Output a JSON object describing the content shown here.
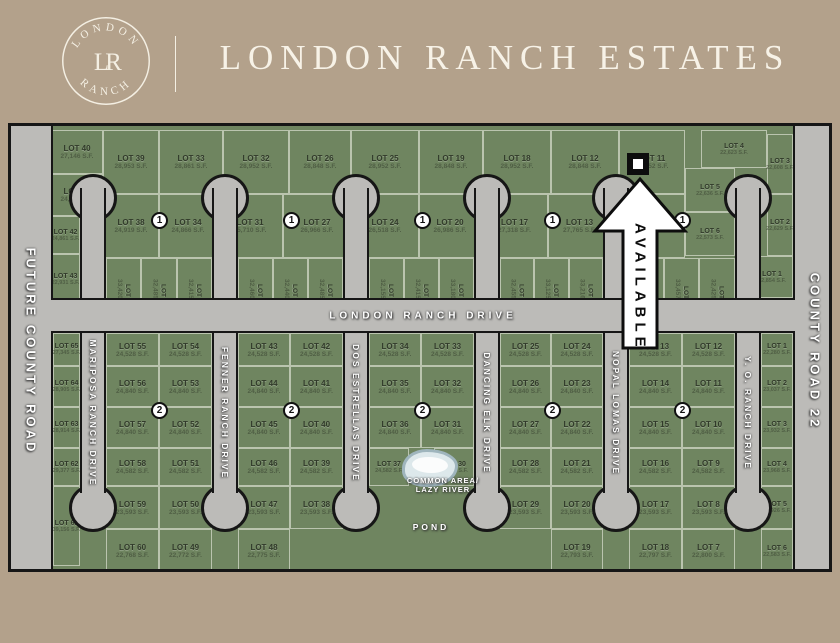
{
  "header": {
    "logo_top": "LONDON",
    "logo_bottom": "RANCH",
    "logo_monogram": "LR",
    "title": "LONDON RANCH ESTATES"
  },
  "roads": {
    "left": "FUTURE COUNTY ROAD",
    "right": "COUNTY ROAD 22",
    "main": "LONDON RANCH DRIVE",
    "south_streets": [
      "MARIPOSA RANCH DRIVE",
      "FENNER RANCH DRIVE",
      "DOS ESTRELLAS DRIVE",
      "DANCING ELK DRIVE",
      "NOPAL LOMAS DRIVE",
      "Y. O. RANCH DRIVE"
    ]
  },
  "badges": {
    "unit1": "1",
    "unit2": "2"
  },
  "available_marker": {
    "label": "AVAILABLE"
  },
  "common_area": {
    "line1": "COMMON AREA/",
    "line2": "LAZY RIVER",
    "pond": "POND"
  },
  "colors": {
    "background_tan": "#b3a18b",
    "map_green": "#6f8560",
    "road_gray": "#bcbbb8",
    "outline_black": "#161616",
    "cream": "#f7f2e7"
  },
  "north_lots": [
    {
      "id": "N40",
      "label": "LOT 40",
      "sf": "27,146 S.F."
    },
    {
      "id": "N39",
      "label": "LOT 39",
      "sf": "28,953 S.F."
    },
    {
      "id": "N33",
      "label": "LOT 33",
      "sf": "28,861 S.F."
    },
    {
      "id": "N32",
      "label": "LOT 32",
      "sf": "28,952 S.F."
    },
    {
      "id": "N26",
      "label": "LOT 26",
      "sf": "28,848 S.F."
    },
    {
      "id": "N25",
      "label": "LOT 25",
      "sf": "28,952 S.F."
    },
    {
      "id": "N19",
      "label": "LOT 19",
      "sf": "28,848 S.F."
    },
    {
      "id": "N18",
      "label": "LOT 18",
      "sf": "28,952 S.F."
    },
    {
      "id": "N12",
      "label": "LOT 12",
      "sf": "28,848 S.F."
    },
    {
      "id": "N11",
      "label": "LOT 11",
      "sf": "28,952 S.F."
    },
    {
      "id": "N4",
      "label": "LOT 4",
      "sf": "22,623 S.F."
    },
    {
      "id": "N3",
      "label": "LOT 3",
      "sf": "22,608 S.F."
    },
    {
      "id": "N41",
      "label": "LOT 41",
      "sf": "24,885 S.F."
    },
    {
      "id": "N38",
      "label": "LOT 38",
      "sf": "24,919 S.F."
    },
    {
      "id": "N34",
      "label": "LOT 34",
      "sf": "24,866 S.F."
    },
    {
      "id": "N31",
      "label": "LOT 31",
      "sf": "25,710 S.F."
    },
    {
      "id": "N27",
      "label": "LOT 27",
      "sf": "26,966 S.F."
    },
    {
      "id": "N24",
      "label": "LOT 24",
      "sf": "26,518 S.F."
    },
    {
      "id": "N20",
      "label": "LOT 20",
      "sf": "26,986 S.F."
    },
    {
      "id": "N17",
      "label": "LOT 17",
      "sf": "27,318 S.F."
    },
    {
      "id": "N13",
      "label": "LOT 13",
      "sf": "27,765 S.F."
    },
    {
      "id": "N10",
      "label": "LOT 10",
      "sf": "27,318 S.F."
    },
    {
      "id": "N5",
      "label": "LOT 5",
      "sf": "22,636 S.F."
    },
    {
      "id": "N6",
      "label": "LOT 6",
      "sf": "22,573 S.F."
    },
    {
      "id": "N2",
      "label": "LOT 2",
      "sf": "22,629 S.F."
    },
    {
      "id": "N42",
      "label": "LOT 42",
      "sf": "24,861 S.F."
    },
    {
      "id": "N43",
      "label": "LOT 43",
      "sf": "22,931 S.F."
    },
    {
      "id": "N37",
      "label": "LOT 37",
      "sf": "33,420 S.F."
    },
    {
      "id": "N36",
      "label": "LOT 36",
      "sf": "32,485 S.F."
    },
    {
      "id": "N35",
      "label": "LOT 35",
      "sf": "32,415 S.F."
    },
    {
      "id": "N30",
      "label": "LOT 30",
      "sf": "32,460 S.F."
    },
    {
      "id": "N29",
      "label": "LOT 29",
      "sf": "32,440 S.F."
    },
    {
      "id": "N28",
      "label": "LOT 28",
      "sf": "32,485 S.F."
    },
    {
      "id": "N23",
      "label": "LOT 23",
      "sf": "32,155 S.F."
    },
    {
      "id": "N22",
      "label": "LOT 22",
      "sf": "32,415 S.F."
    },
    {
      "id": "N21",
      "label": "LOT 21",
      "sf": "33,180 S.F."
    },
    {
      "id": "N16",
      "label": "LOT 16",
      "sf": "32,455 S.F."
    },
    {
      "id": "N15",
      "label": "LOT 15",
      "sf": "33,125 S.F."
    },
    {
      "id": "N14",
      "label": "LOT 14",
      "sf": "33,216 S.F."
    },
    {
      "id": "N9",
      "label": "LOT 9",
      "sf": "32,440 S.F."
    },
    {
      "id": "N8",
      "label": "LOT 8",
      "sf": "33,457 S.F."
    },
    {
      "id": "N7",
      "label": "LOT 7",
      "sf": "32,425 S.F."
    },
    {
      "id": "N1",
      "label": "LOT 1",
      "sf": "42,854 S.F."
    }
  ],
  "south_lots": [
    {
      "id": "S65",
      "label": "LOT 65",
      "sf": "27,345 S.F."
    },
    {
      "id": "S64",
      "label": "LOT 64",
      "sf": "28,905 S.F."
    },
    {
      "id": "S63",
      "label": "LOT 63",
      "sf": "28,914 S.F."
    },
    {
      "id": "S62",
      "label": "LOT 62",
      "sf": "29,377 S.F."
    },
    {
      "id": "S61",
      "label": "LOT 61",
      "sf": "39,156 S.F."
    },
    {
      "id": "S55",
      "label": "LOT 55",
      "sf": "24,528 S.F."
    },
    {
      "id": "S56",
      "label": "LOT 56",
      "sf": "24,840 S.F."
    },
    {
      "id": "S57",
      "label": "LOT 57",
      "sf": "24,840 S.F."
    },
    {
      "id": "S58",
      "label": "LOT 58",
      "sf": "24,582 S.F."
    },
    {
      "id": "S59",
      "label": "LOT 59",
      "sf": "23,593 S.F."
    },
    {
      "id": "S60",
      "label": "LOT 60",
      "sf": "22,768 S.F."
    },
    {
      "id": "S54",
      "label": "LOT 54",
      "sf": "24,528 S.F."
    },
    {
      "id": "S53",
      "label": "LOT 53",
      "sf": "24,840 S.F."
    },
    {
      "id": "S52",
      "label": "LOT 52",
      "sf": "24,840 S.F."
    },
    {
      "id": "S51",
      "label": "LOT 51",
      "sf": "24,582 S.F."
    },
    {
      "id": "S50",
      "label": "LOT 50",
      "sf": "23,593 S.F."
    },
    {
      "id": "S49",
      "label": "LOT 49",
      "sf": "22,772 S.F."
    },
    {
      "id": "S43",
      "label": "LOT 43",
      "sf": "24,528 S.F."
    },
    {
      "id": "S44",
      "label": "LOT 44",
      "sf": "24,840 S.F."
    },
    {
      "id": "S45",
      "label": "LOT 45",
      "sf": "24,840 S.F."
    },
    {
      "id": "S46",
      "label": "LOT 46",
      "sf": "24,582 S.F."
    },
    {
      "id": "S47",
      "label": "LOT 47",
      "sf": "23,593 S.F."
    },
    {
      "id": "S48",
      "label": "LOT 48",
      "sf": "22,775 S.F."
    },
    {
      "id": "S42",
      "label": "LOT 42",
      "sf": "24,528 S.F."
    },
    {
      "id": "S41",
      "label": "LOT 41",
      "sf": "24,840 S.F."
    },
    {
      "id": "S40",
      "label": "LOT 40",
      "sf": "24,840 S.F."
    },
    {
      "id": "S39",
      "label": "LOT 39",
      "sf": "24,582 S.F."
    },
    {
      "id": "S38",
      "label": "LOT 38",
      "sf": "23,593 S.F."
    },
    {
      "id": "S34",
      "label": "LOT 34",
      "sf": "24,528 S.F."
    },
    {
      "id": "S35",
      "label": "LOT 35",
      "sf": "24,840 S.F."
    },
    {
      "id": "S36",
      "label": "LOT 36",
      "sf": "24,840 S.F."
    },
    {
      "id": "S37",
      "label": "LOT 37",
      "sf": "24,582 S.F."
    },
    {
      "id": "S33",
      "label": "LOT 33",
      "sf": "24,528 S.F."
    },
    {
      "id": "S32",
      "label": "LOT 32",
      "sf": "24,840 S.F."
    },
    {
      "id": "S31",
      "label": "LOT 31",
      "sf": "24,840 S.F."
    },
    {
      "id": "S30",
      "label": "LOT 30",
      "sf": "24,582 S.F."
    },
    {
      "id": "S25",
      "label": "LOT 25",
      "sf": "24,528 S.F."
    },
    {
      "id": "S26",
      "label": "LOT 26",
      "sf": "24,840 S.F."
    },
    {
      "id": "S27",
      "label": "LOT 27",
      "sf": "24,840 S.F."
    },
    {
      "id": "S28",
      "label": "LOT 28",
      "sf": "24,582 S.F."
    },
    {
      "id": "S29",
      "label": "LOT 29",
      "sf": "23,593 S.F."
    },
    {
      "id": "S24",
      "label": "LOT 24",
      "sf": "24,528 S.F."
    },
    {
      "id": "S23",
      "label": "LOT 23",
      "sf": "24,840 S.F."
    },
    {
      "id": "S22",
      "label": "LOT 22",
      "sf": "24,840 S.F."
    },
    {
      "id": "S21",
      "label": "LOT 21",
      "sf": "24,582 S.F."
    },
    {
      "id": "S20",
      "label": "LOT 20",
      "sf": "23,593 S.F."
    },
    {
      "id": "S19",
      "label": "LOT 19",
      "sf": "22,793 S.F."
    },
    {
      "id": "S13",
      "label": "LOT 13",
      "sf": "24,528 S.F."
    },
    {
      "id": "S14",
      "label": "LOT 14",
      "sf": "24,840 S.F."
    },
    {
      "id": "S15",
      "label": "LOT 15",
      "sf": "24,840 S.F."
    },
    {
      "id": "S16",
      "label": "LOT 16",
      "sf": "24,582 S.F."
    },
    {
      "id": "S17",
      "label": "LOT 17",
      "sf": "23,593 S.F."
    },
    {
      "id": "S18",
      "label": "LOT 18",
      "sf": "22,797 S.F."
    },
    {
      "id": "S12",
      "label": "LOT 12",
      "sf": "24,528 S.F."
    },
    {
      "id": "S11",
      "label": "LOT 11",
      "sf": "24,840 S.F."
    },
    {
      "id": "S10",
      "label": "LOT 10",
      "sf": "24,840 S.F."
    },
    {
      "id": "S9",
      "label": "LOT 9",
      "sf": "24,582 S.F."
    },
    {
      "id": "S8",
      "label": "LOT 8",
      "sf": "23,593 S.F."
    },
    {
      "id": "S7",
      "label": "LOT 7",
      "sf": "22,800 S.F."
    },
    {
      "id": "S1",
      "label": "LOT 1",
      "sf": "22,280 S.F."
    },
    {
      "id": "S2",
      "label": "LOT 2",
      "sf": "23,037 S.F."
    },
    {
      "id": "S3",
      "label": "LOT 3",
      "sf": "23,932 S.F."
    },
    {
      "id": "S4",
      "label": "LOT 4",
      "sf": "23,968 S.F."
    },
    {
      "id": "S5",
      "label": "LOT 5",
      "sf": "23,926 S.F."
    },
    {
      "id": "S6",
      "label": "LOT 6",
      "sf": "22,583 S.F."
    }
  ]
}
